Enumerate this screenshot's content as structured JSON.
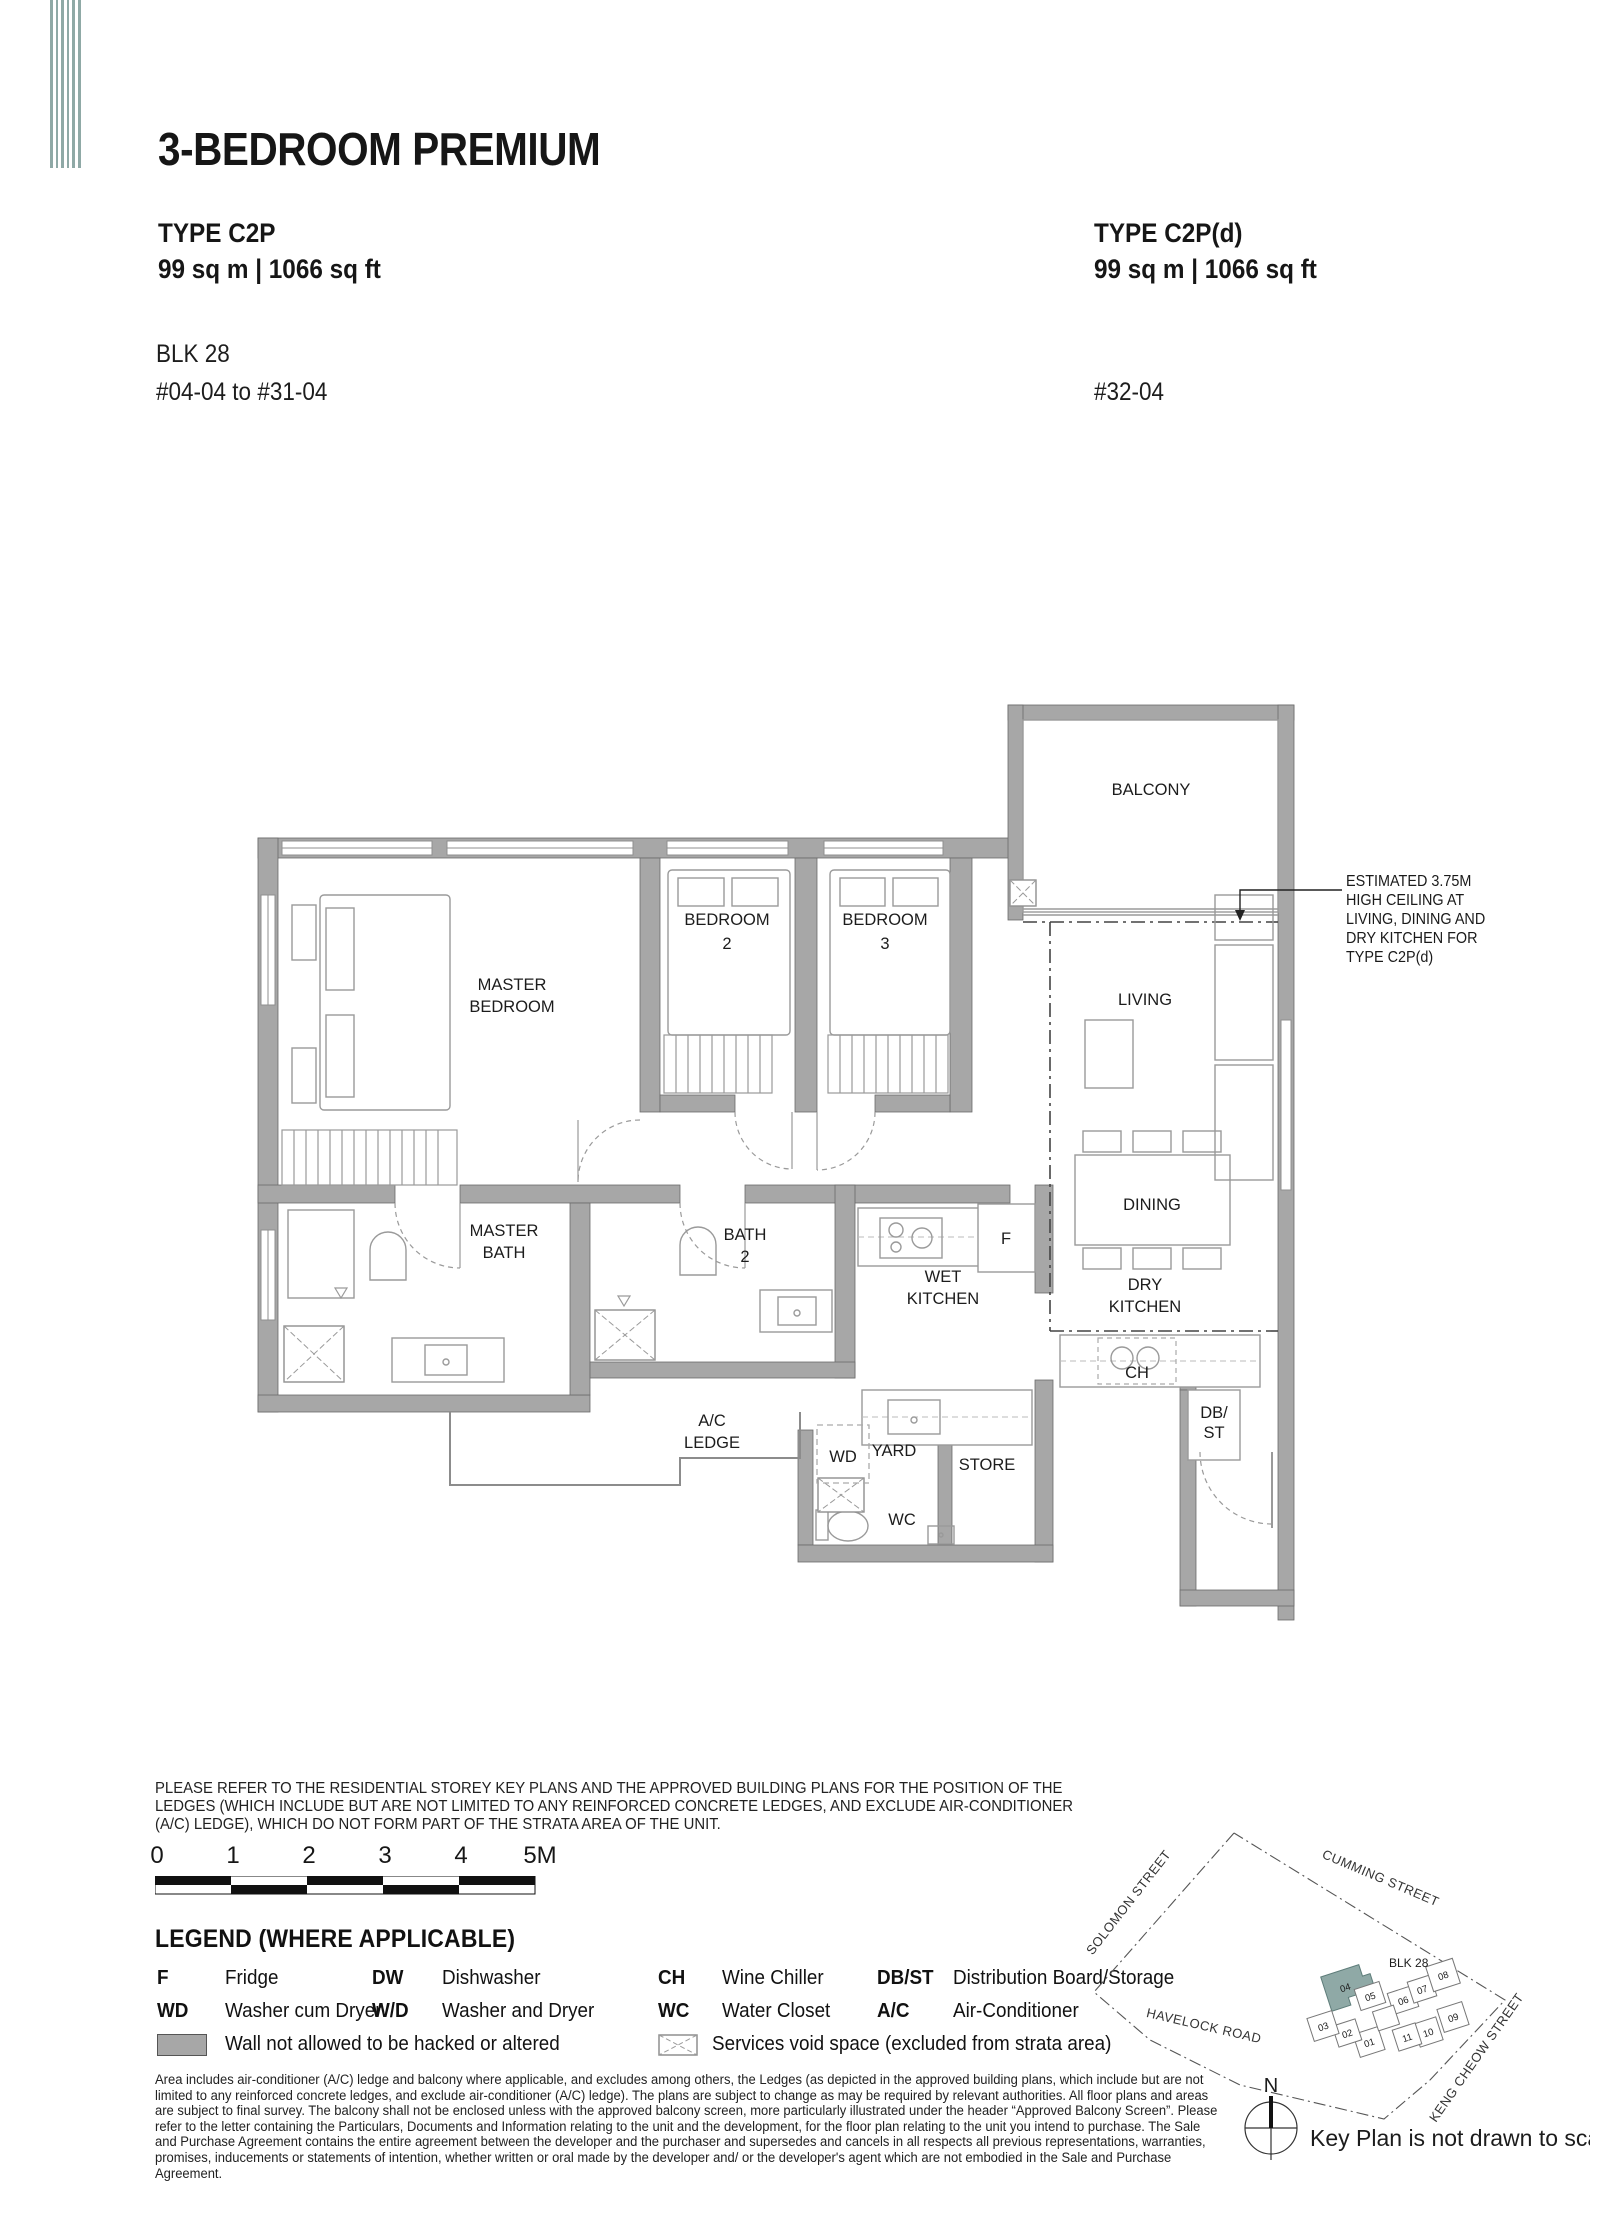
{
  "colors": {
    "accent_teal": "#8fa9a6",
    "wall_gray": "#a7a7a7"
  },
  "header": {
    "title": "3-BEDROOM PREMIUM"
  },
  "units": {
    "left": {
      "type": "TYPE C2P",
      "area": "99 sq m  |  1066 sq ft",
      "block": "BLK 28",
      "floors": "#04-04 to #31-04"
    },
    "right": {
      "type": "TYPE C2P(d)",
      "area": "99 sq m  |  1066 sq ft",
      "floors": "#32-04"
    }
  },
  "floorplan": {
    "labels": {
      "balcony": "BALCONY",
      "master_bedroom_1": "MASTER",
      "master_bedroom_2": "BEDROOM",
      "bedroom2_1": "BEDROOM",
      "bedroom2_2": "2",
      "bedroom3_1": "BEDROOM",
      "bedroom3_2": "3",
      "living": "LIVING",
      "dining": "DINING",
      "wet_kitchen_1": "WET",
      "wet_kitchen_2": "KITCHEN",
      "dry_kitchen_1": "DRY",
      "dry_kitchen_2": "KITCHEN",
      "master_bath_1": "MASTER",
      "master_bath_2": "BATH",
      "bath2_1": "BATH",
      "bath2_2": "2",
      "ac_ledge_1": "A/C",
      "ac_ledge_2": "LEDGE",
      "wd": "WD",
      "yard": "YARD",
      "store": "STORE",
      "wc": "WC",
      "f": "F",
      "ch": "CH",
      "dbst_1": "DB/",
      "dbst_2": "ST"
    },
    "annotation": {
      "line1": "ESTIMATED 3.75M",
      "line2": "HIGH CEILING AT",
      "line3": "LIVING, DINING AND",
      "line4": "DRY KITCHEN FOR",
      "line5": "TYPE C2P(d)"
    }
  },
  "notes": {
    "disclaimer_l1": "PLEASE REFER TO THE RESIDENTIAL STOREY KEY PLANS AND THE APPROVED BUILDING PLANS FOR THE POSITION OF THE",
    "disclaimer_l2": "LEDGES (WHICH INCLUDE BUT ARE NOT LIMITED TO ANY REINFORCED CONCRETE LEDGES, AND EXCLUDE AIR-CONDITIONER",
    "disclaimer_l3": "(A/C) LEDGE), WHICH DO NOT FORM PART OF THE STRATA AREA OF THE UNIT."
  },
  "scalebar": {
    "labels": [
      "0",
      "1",
      "2",
      "3",
      "4",
      "5M"
    ]
  },
  "legend": {
    "heading": "LEGEND (WHERE APPLICABLE)",
    "rows": [
      [
        {
          "key": "F",
          "value": "Fridge"
        },
        {
          "key": "DW",
          "value": "Dishwasher"
        },
        {
          "key": "CH",
          "value": "Wine Chiller"
        },
        {
          "key": "DB/ST",
          "value": "Distribution Board/Storage"
        }
      ],
      [
        {
          "key": "WD",
          "value": "Washer cum Dryer"
        },
        {
          "key": "W/D",
          "value": "Washer and Dryer"
        },
        {
          "key": "WC",
          "value": "Water Closet"
        },
        {
          "key": "A/C",
          "value": "Air-Conditioner"
        }
      ]
    ],
    "wall_note": "Wall not allowed to be hacked or altered",
    "void_note": "Services void space (excluded from strata area)"
  },
  "fineprint": {
    "l1": "Area includes air-conditioner (A/C) ledge and balcony where applicable, and excludes among others, the Ledges (as depicted in the approved building plans, which include but are not",
    "l2": "limited to any reinforced concrete ledges, and exclude air-conditioner (A/C) ledge). The plans are subject to change as may be required by relevant authorities. All floor plans and areas",
    "l3": "are subject to final survey. The balcony shall not be enclosed unless with the approved balcony screen, more particularly illustrated under the header “Approved Balcony Screen”. Please",
    "l4": "refer to the letter containing the Particulars, Documents and Information relating to the unit and the development, for the floor plan relating to the unit you intend to purchase. The Sale",
    "l5": "and Purchase Agreement contains the entire agreement between the developer and the purchaser and supersedes and cancels in all respects all previous representations, warranties,",
    "l6": "promises, inducements or statements of intention, whether written or oral made by the developer and/ or the developer's agent which are not embodied in the Sale and Purchase",
    "l7": "Agreement."
  },
  "keyplan": {
    "streets": {
      "solomon": "SOLOMON STREET",
      "cumming": "CUMMING STREET",
      "havelock": "HAVELOCK ROAD",
      "keng_cheow": "KENG CHEOW STREET"
    },
    "blk": "BLK 28",
    "units": [
      "01",
      "02",
      "03",
      "04",
      "05",
      "06",
      "07",
      "08",
      "09",
      "10",
      "11"
    ],
    "highlight_unit": "04",
    "north": "N",
    "note": "Key Plan is not drawn to scale"
  }
}
